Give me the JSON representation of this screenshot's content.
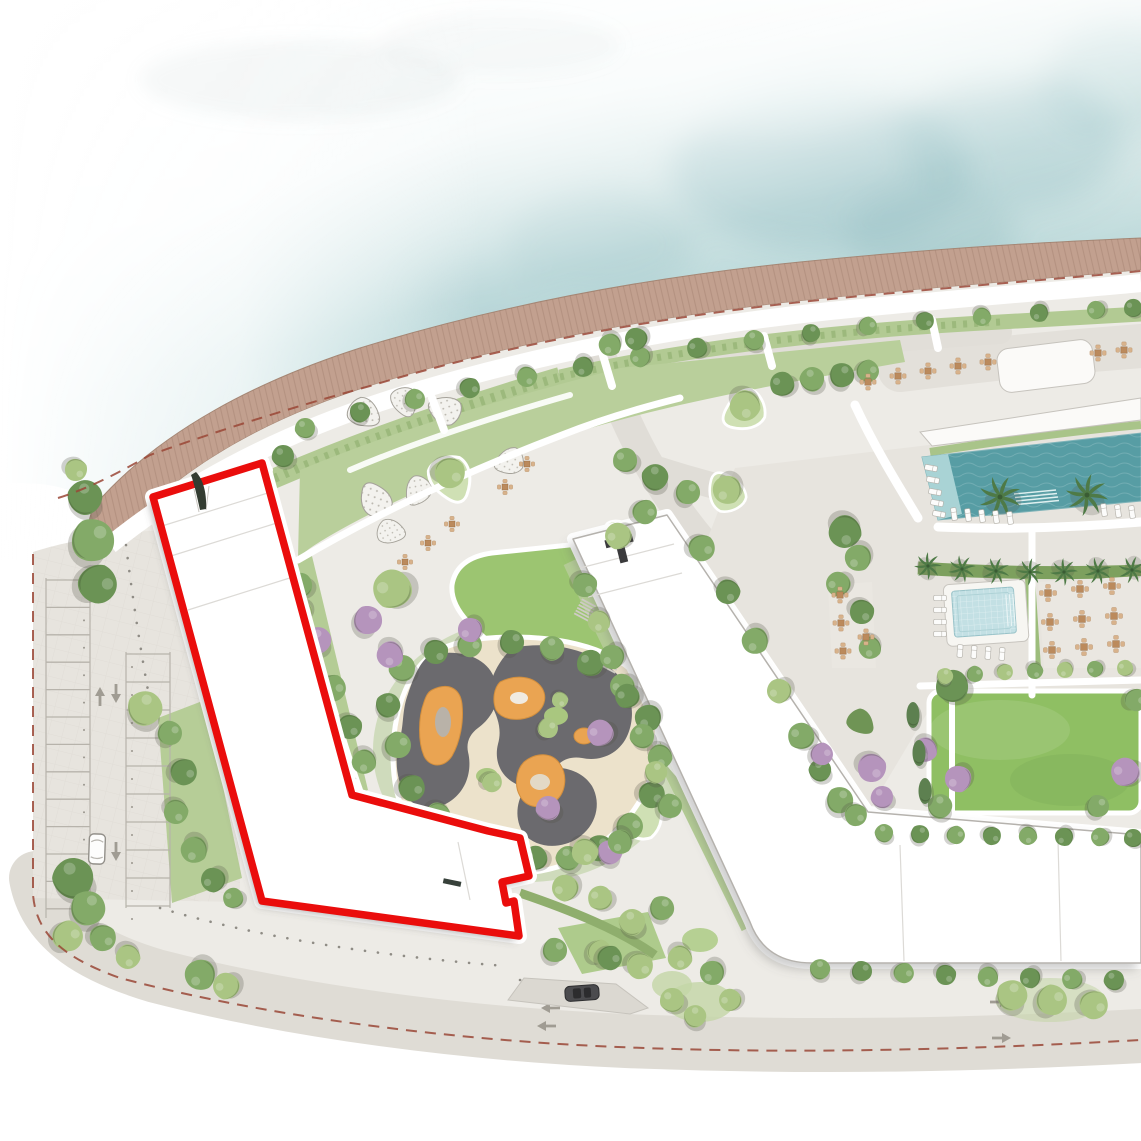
{
  "app": {
    "type": "architectural-site-plan",
    "description": "Watercolor masterplan rendering of a beachfront residential development; one building plot is highlighted with a thick red outline"
  },
  "palette": {
    "page": "#ffffff",
    "water_deep": "#5f9ea5",
    "water_mid": "#8fc1c3",
    "water_pale": "#cfe4e4",
    "boardwalk": "#c2a08f",
    "boardwalk_plank": "#8f6c5b",
    "ground": "#edebe6",
    "road": "#e0ddd7",
    "path_white": "#ffffff",
    "green_band": "#b2ca93",
    "green_park": "#b9cf9b",
    "lawn": "#8fbf63",
    "lawn_small": "#9cc571",
    "hedge": "#7da05e",
    "tree_green": "#83aa68",
    "tree_dark": "#6b9355",
    "tree_light": "#aac583",
    "tree_yellow": "#c3d795",
    "tree_purple": "#b594bc",
    "palm": "#4e7a46",
    "cypress": "#5d8050",
    "play_dark": "#6b6a6e",
    "play_orange": "#eaa452",
    "play_sand": "#ece2cb",
    "pool": "#579da4",
    "pool_shelf": "#a9d3d5",
    "kids_pool": "#c3e0e4",
    "gravel_bed": "#f3f2ee",
    "table_tan": "#bb8a5c",
    "chair_tan": "#d8b28b",
    "highlight_outline": "#ea0d0c",
    "building_stroke": "#b5b2ad",
    "boundary_dash": "#9a4636",
    "arrow": "#a09c93",
    "car_white": "#fdfdfc",
    "car_dark": "#4b4b4e"
  },
  "site": {
    "water": "sea",
    "beachfront": "timber-boardwalk",
    "buildings": [
      {
        "id": "building-a",
        "highlighted": true,
        "outline_color": "#ea0d0c"
      },
      {
        "id": "building-b",
        "highlighted": false
      }
    ],
    "amenities": [
      "beach-promenade",
      "main-pool",
      "kids-pool",
      "playground",
      "event-lawn",
      "terrace-seating",
      "gravel-planting-beds"
    ],
    "parking": {
      "stall_rows": 2,
      "direction_arrows": 3
    },
    "vehicles": [
      {
        "id": "car-white",
        "location": "parking-aisle"
      },
      {
        "id": "car-dark",
        "location": "south-road"
      }
    ]
  }
}
